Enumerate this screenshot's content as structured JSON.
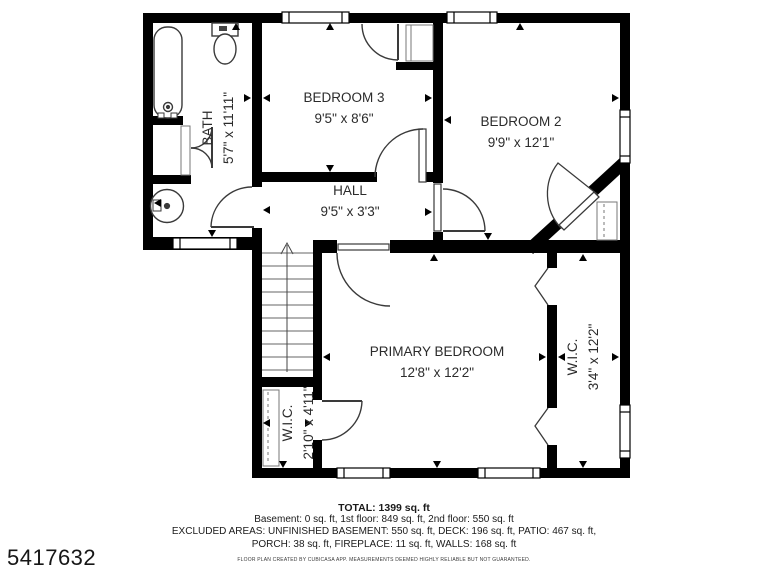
{
  "page_id": "5417632",
  "colors": {
    "wall": "#000000",
    "floor": "#ffffff",
    "text": "#2b2b2b"
  },
  "rooms": {
    "bath": {
      "name": "BATH",
      "dims": "5'7\" x 11'11\""
    },
    "bedroom3": {
      "name": "BEDROOM 3",
      "dims": "9'5\" x 8'6\""
    },
    "bedroom2": {
      "name": "BEDROOM 2",
      "dims": "9'9\" x 12'1\""
    },
    "hall": {
      "name": "HALL",
      "dims": "9'5\" x 3'3\""
    },
    "primary_bedroom": {
      "name": "PRIMARY BEDROOM",
      "dims": "12'8\" x 12'2\""
    },
    "wic_left": {
      "name": "W.I.C.",
      "dims": "2'10\" x 4'11\""
    },
    "wic_right": {
      "name": "W.I.C.",
      "dims": "3'4\" x 12'2\""
    }
  },
  "summary": {
    "total": "TOTAL: 1399 sq. ft",
    "floors": "Basement: 0 sq. ft, 1st floor: 849 sq. ft, 2nd floor: 550 sq. ft",
    "excluded_line1": "EXCLUDED AREAS: UNFINISHED BASEMENT: 550 sq. ft, DECK: 196 sq. ft, PATIO: 467 sq. ft,",
    "excluded_line2": "PORCH: 38 sq. ft, FIREPLACE: 11 sq. ft, WALLS: 168 sq. ft",
    "disclaimer": "FLOOR PLAN CREATED BY CUBICASA APP. MEASUREMENTS DEEMED HIGHLY RELIABLE BUT NOT GUARANTEED."
  }
}
